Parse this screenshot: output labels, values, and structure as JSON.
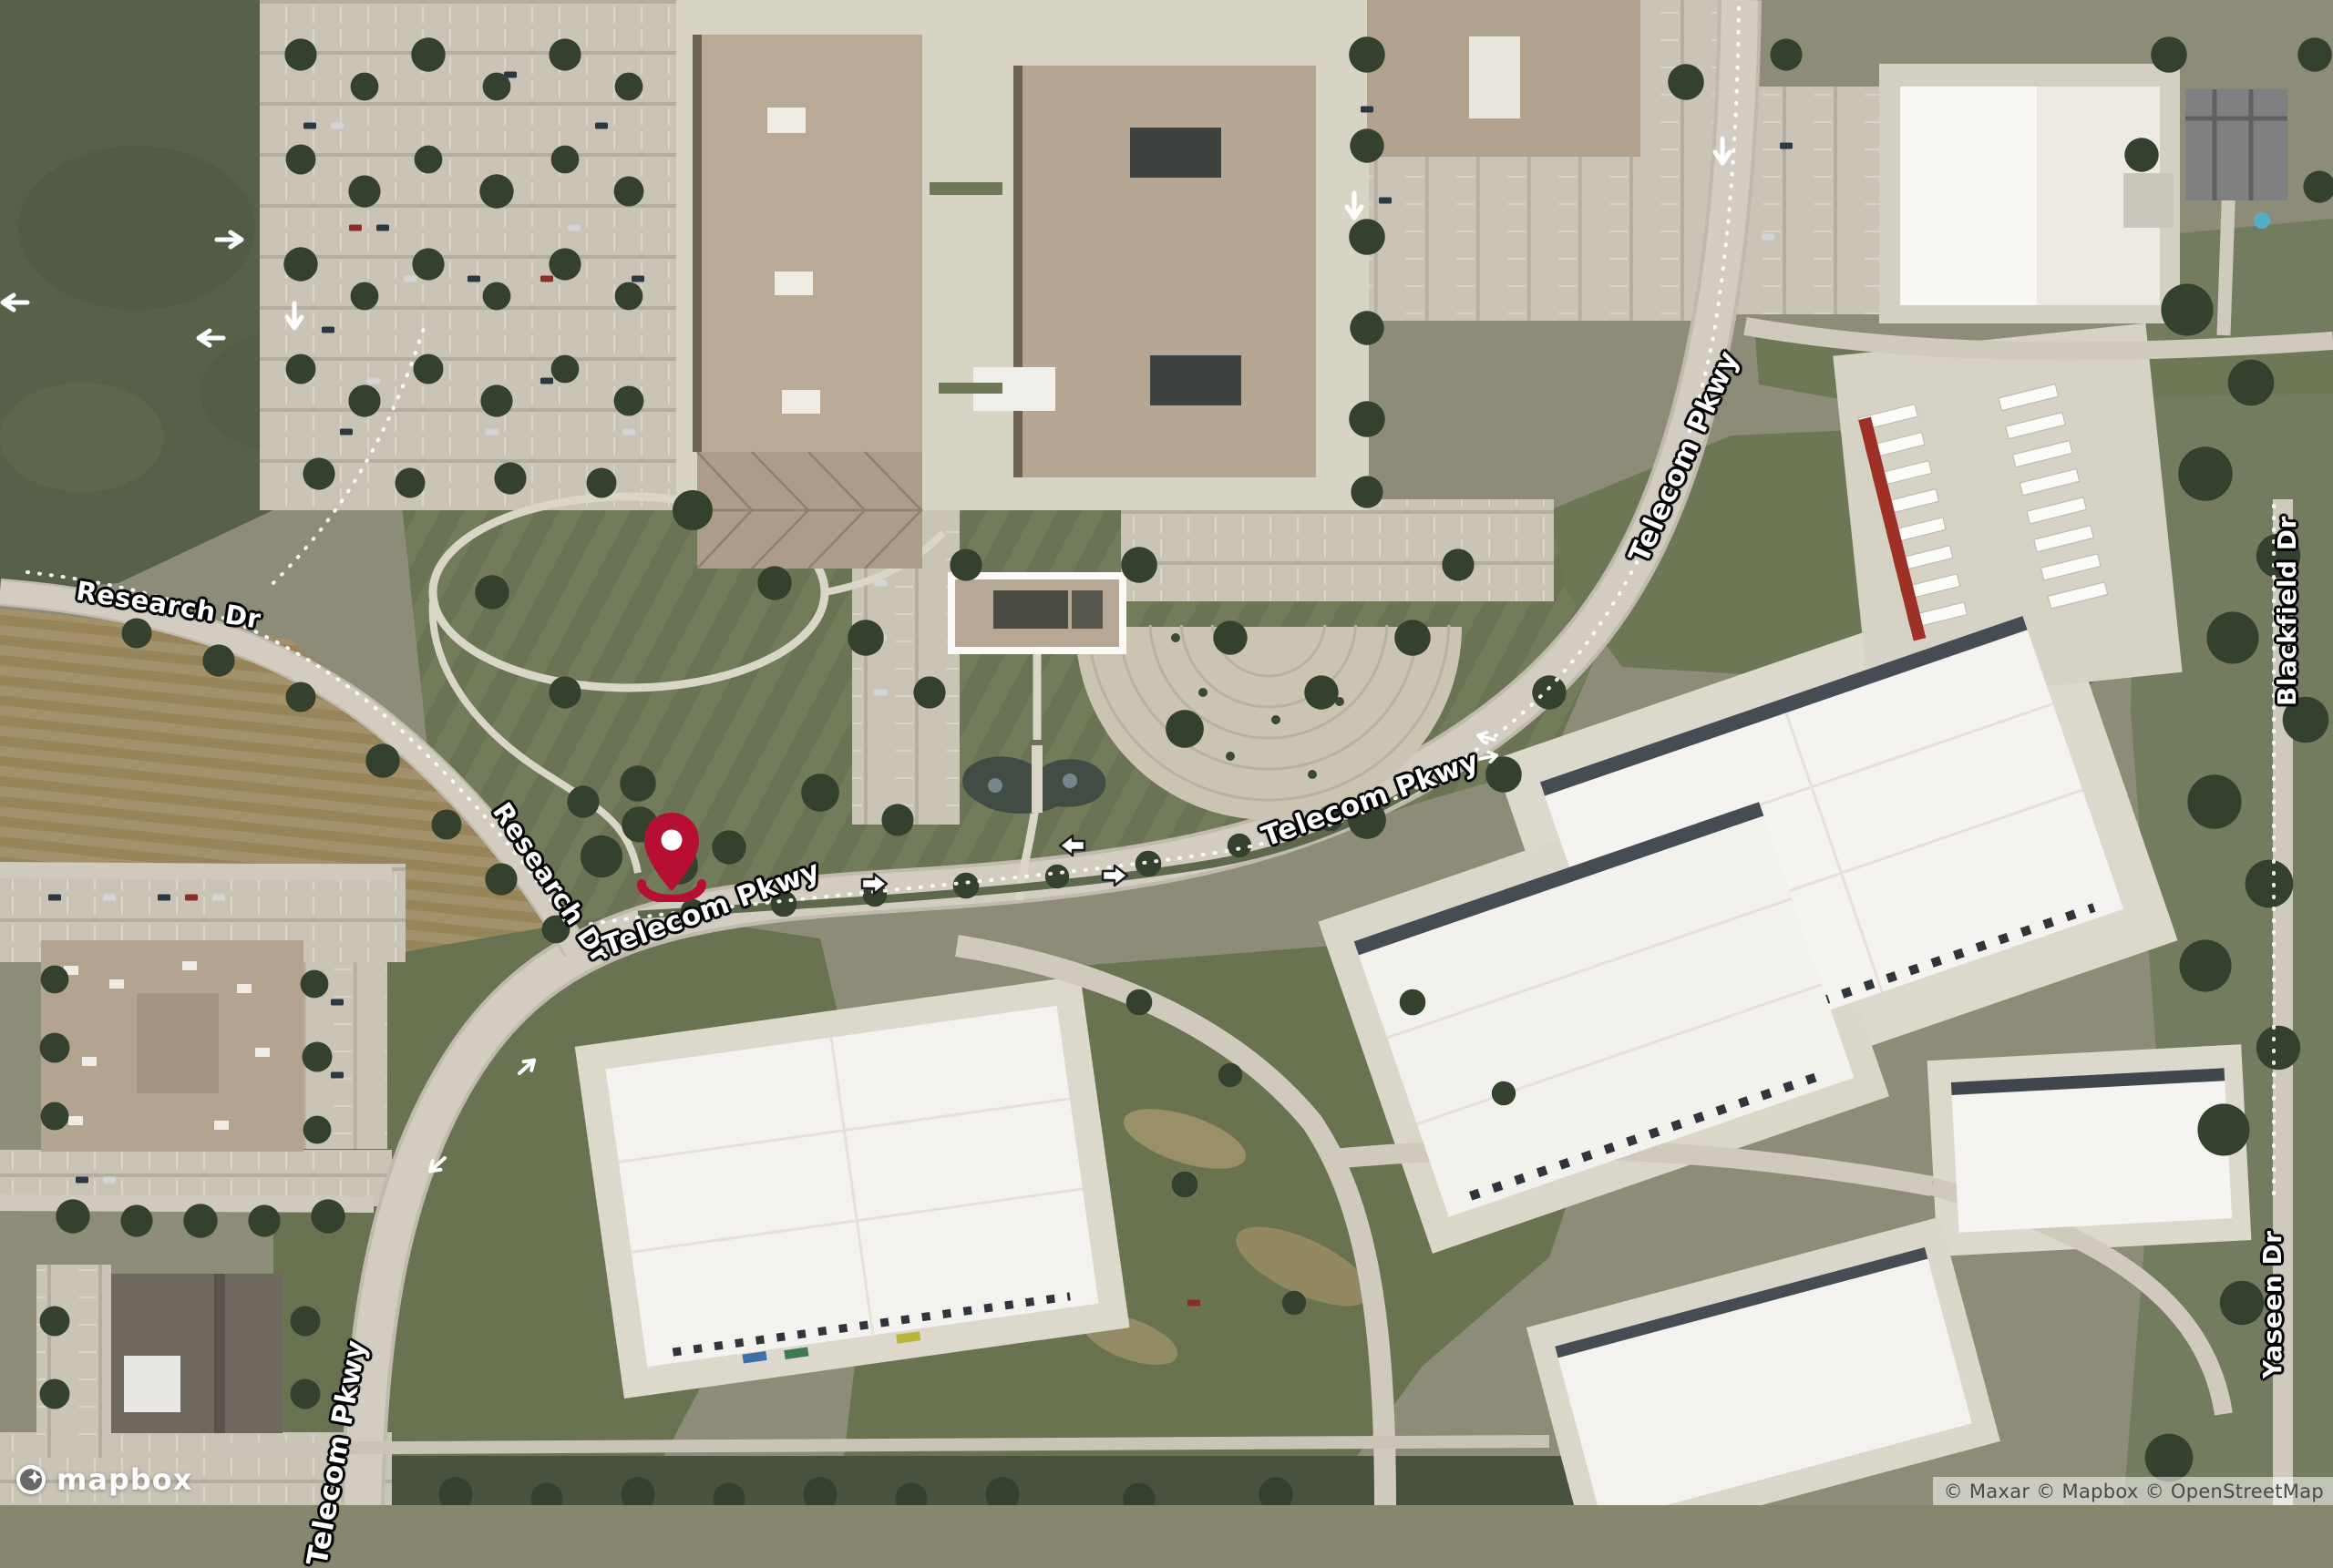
{
  "branding": {
    "logo_text": "mapbox"
  },
  "attribution": {
    "text": "© Maxar © Mapbox © OpenStreetMap"
  },
  "road_labels": [
    {
      "name": "research-dr-west",
      "text": "Research Dr"
    },
    {
      "name": "research-dr-south",
      "text": "Research Dr"
    },
    {
      "name": "telecom-pkwy-at-marker",
      "text": "Telecom Pkwy"
    },
    {
      "name": "telecom-pkwy-central",
      "text": "Telecom Pkwy"
    },
    {
      "name": "telecom-pkwy-north",
      "text": "Telecom Pkwy"
    },
    {
      "name": "telecom-pkwy-south-clipped",
      "text": "Telecom Pkwy"
    },
    {
      "name": "blackfield-dr",
      "text": "Blackfield Dr"
    },
    {
      "name": "yaseen-dr",
      "text": "Yaseen Dr"
    }
  ],
  "marker": {
    "color": "#b60f33"
  }
}
